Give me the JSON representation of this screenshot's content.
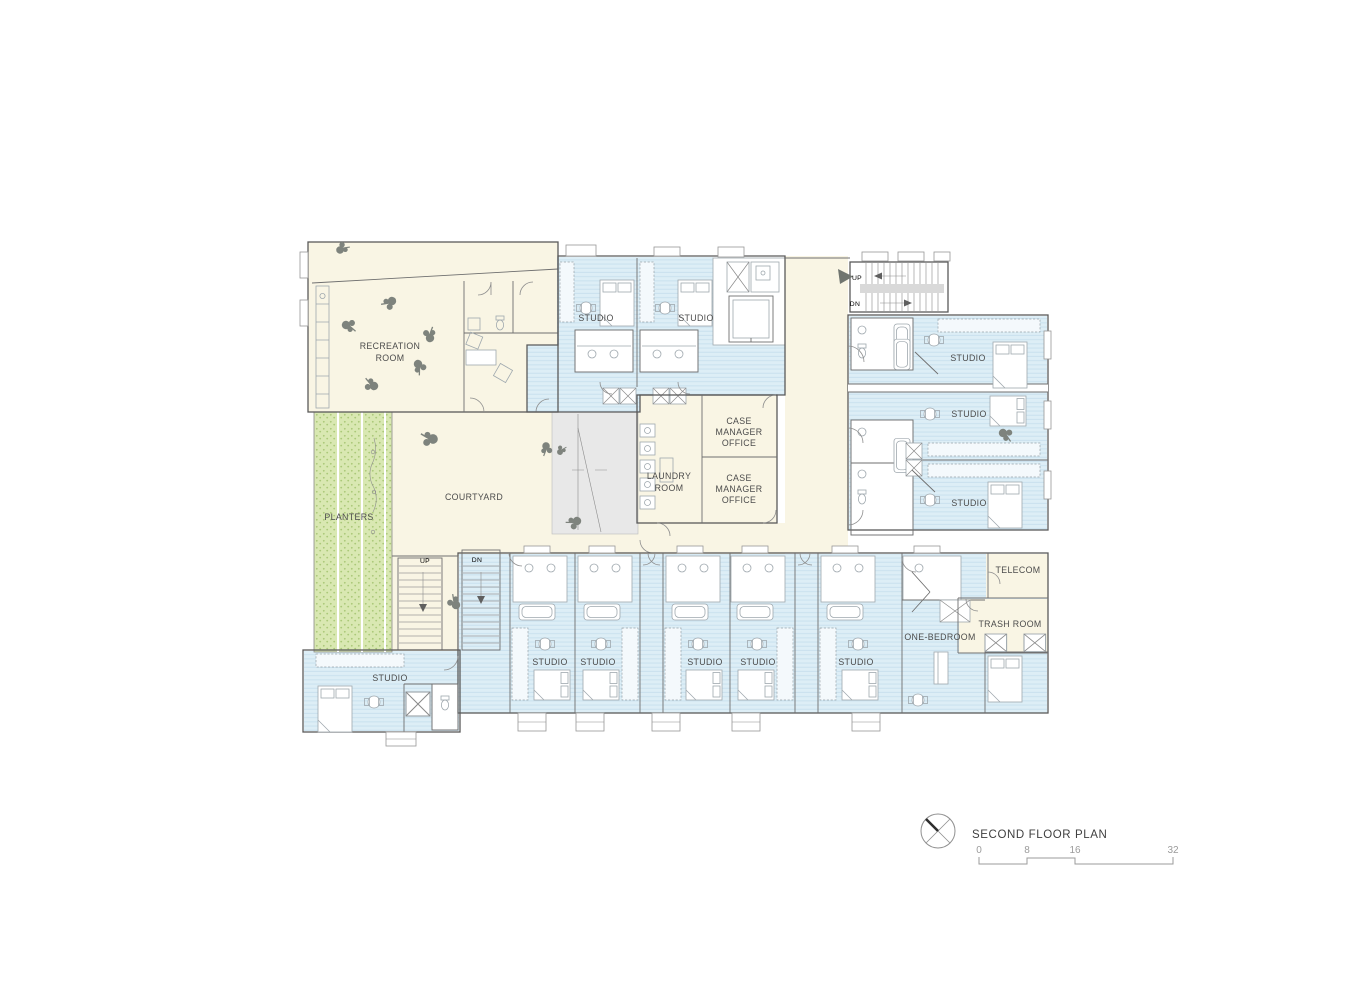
{
  "palette": {
    "room_fill": "#f9f5e4",
    "studio_fill": "#ddeef6",
    "studio_stripe": "#cbe2ef",
    "planter_fill": "#d9e8b2",
    "planter_dot": "#aac878",
    "ramp_fill": "#e8e8e8",
    "wall_line": "#5a5a5a",
    "fixture_line": "#9fa8ae",
    "label_text": "#4c4c4c",
    "scale_text": "#9b9b9b",
    "plant_fill": "#7e837d"
  },
  "labels": {
    "recreation_1": "RECREATION",
    "recreation_2": "ROOM",
    "planters": "PLANTERS",
    "courtyard": "COURTYARD",
    "studio": "STUDIO",
    "laundry_1": "LAUNDRY",
    "laundry_2": "ROOM",
    "case_1": "CASE",
    "case_2": "MANAGER",
    "case_3": "OFFICE",
    "one_bedroom": "ONE-BEDROOM",
    "telecom": "TELECOM",
    "trash_room": "TRASH ROOM",
    "up": "UP",
    "dn": "DN"
  },
  "title_block": {
    "title": "SECOND FLOOR PLAN",
    "scale": {
      "t0": "0",
      "t1": "8",
      "t2": "16",
      "t3": "32"
    }
  }
}
